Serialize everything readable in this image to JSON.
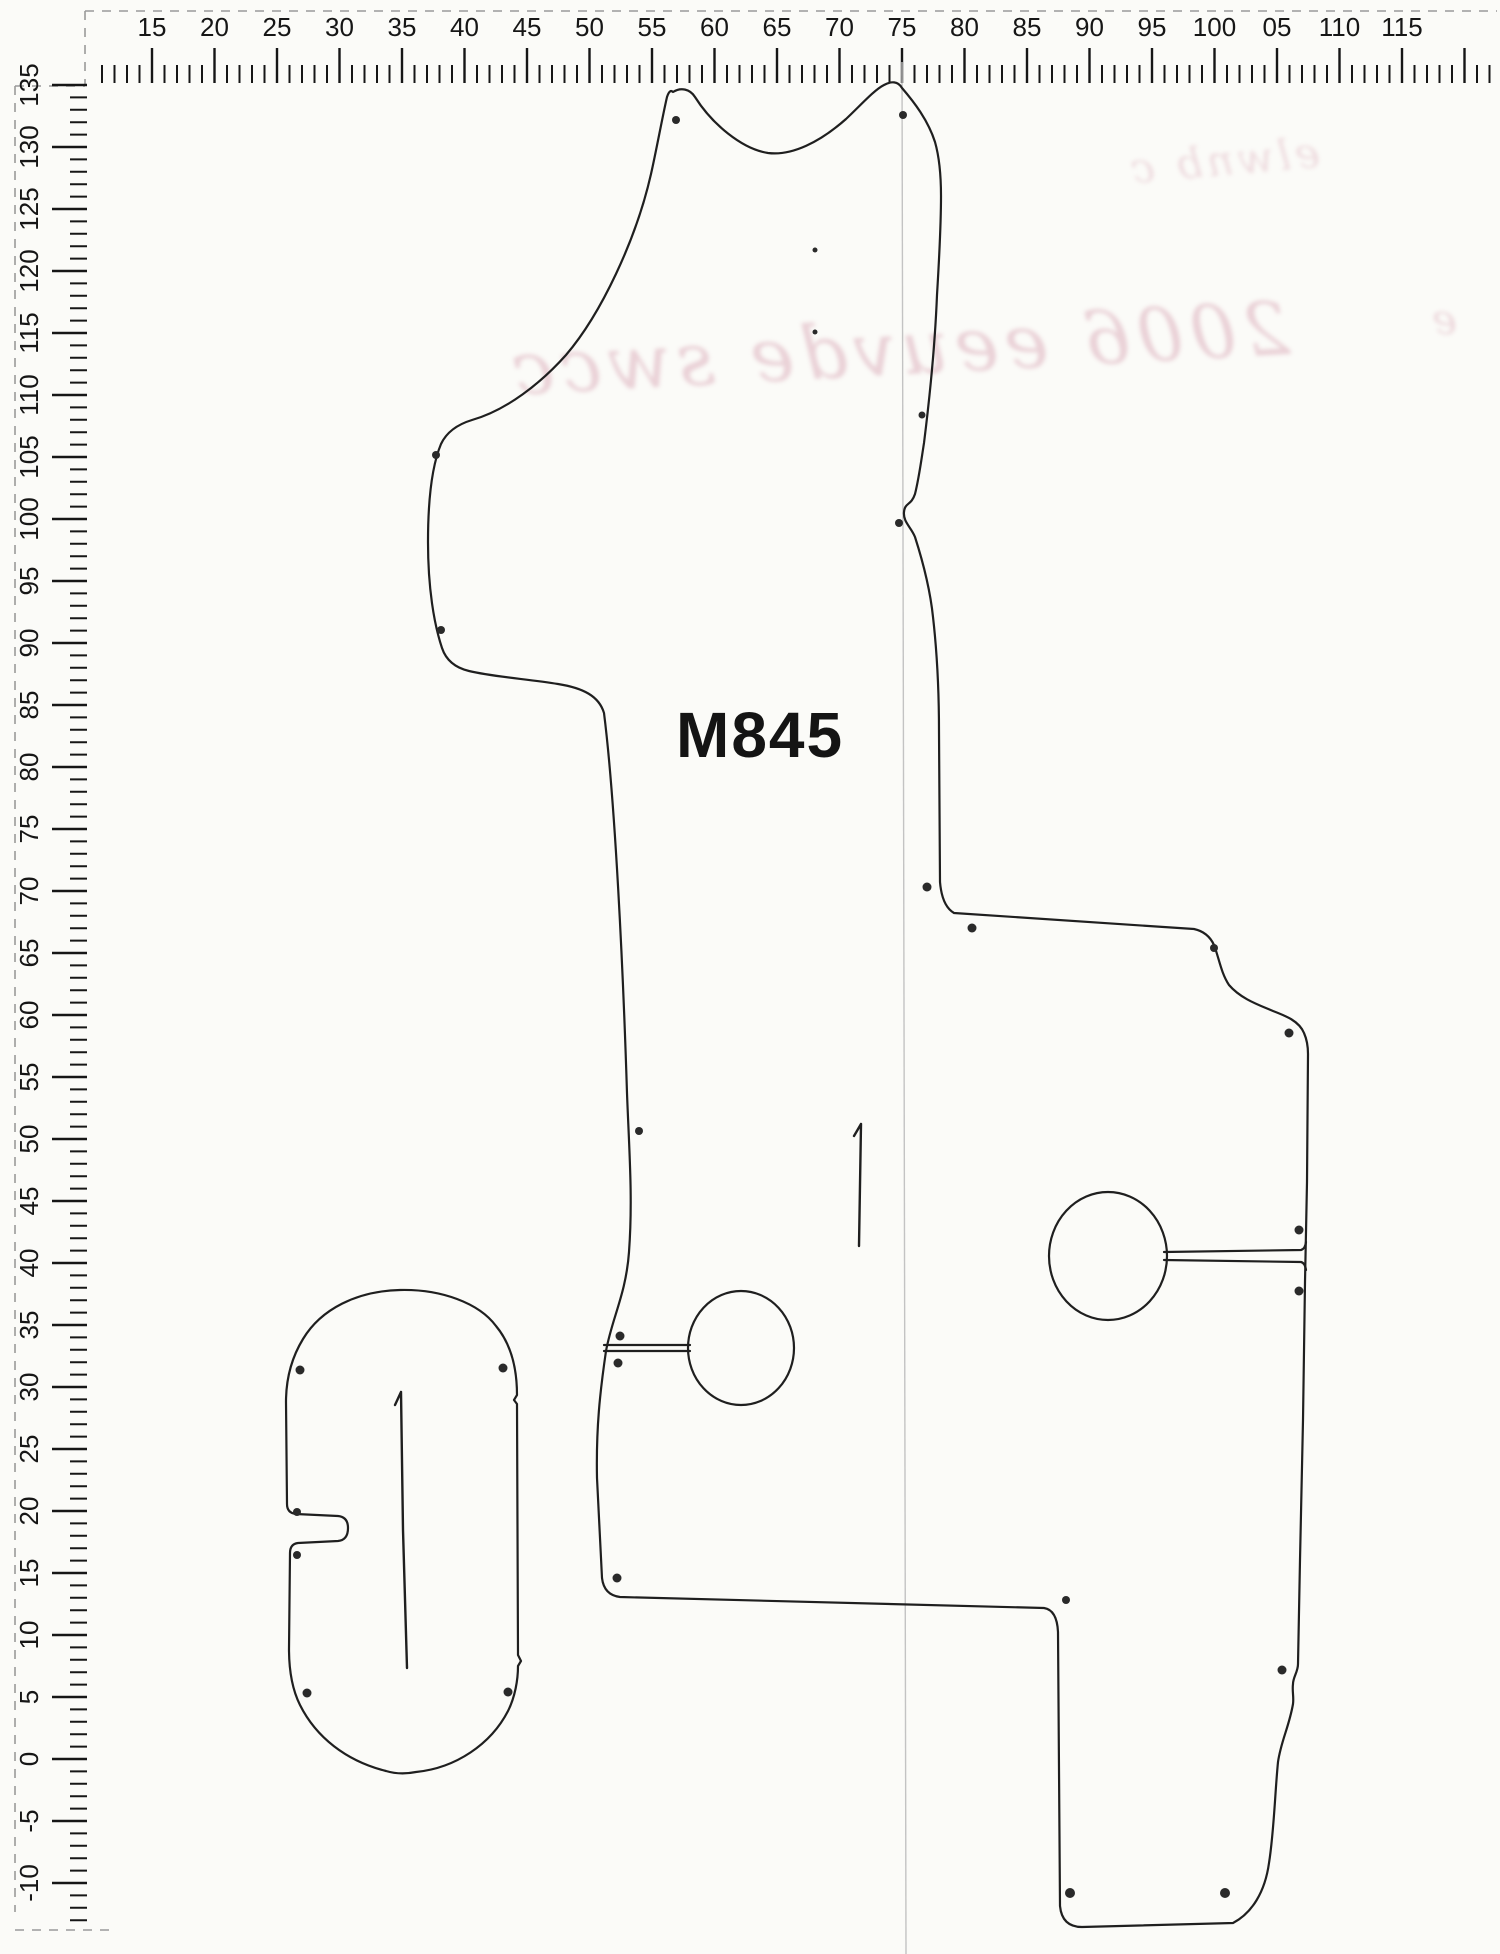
{
  "sheet": {
    "description_label": "M845",
    "units": "cm"
  },
  "part_label": {
    "text": "M845"
  },
  "top_ruler": {
    "orientation": "horizontal",
    "labels": [
      {
        "text": "15",
        "cm": 15
      },
      {
        "text": "20",
        "cm": 20
      },
      {
        "text": "25",
        "cm": 25
      },
      {
        "text": "30",
        "cm": 30
      },
      {
        "text": "35",
        "cm": 35
      },
      {
        "text": "40",
        "cm": 40
      },
      {
        "text": "45",
        "cm": 45
      },
      {
        "text": "50",
        "cm": 50
      },
      {
        "text": "55",
        "cm": 55
      },
      {
        "text": "60",
        "cm": 60
      },
      {
        "text": "65",
        "cm": 65
      },
      {
        "text": "70",
        "cm": 70
      },
      {
        "text": "75",
        "cm": 75
      },
      {
        "text": "80",
        "cm": 80
      },
      {
        "text": "85",
        "cm": 85
      },
      {
        "text": "90",
        "cm": 90
      },
      {
        "text": "95",
        "cm": 95
      },
      {
        "text": "100",
        "cm": 100
      },
      {
        "text": "05",
        "cm": 105
      },
      {
        "text": "110",
        "cm": 110
      },
      {
        "text": "115",
        "cm": 115
      }
    ],
    "px_per_cm": 12.5,
    "origin_cm": 15,
    "origin_px": 152
  },
  "left_ruler": {
    "orientation": "vertical",
    "labels": [
      {
        "text": "135",
        "cm": 135
      },
      {
        "text": "130",
        "cm": 130
      },
      {
        "text": "125",
        "cm": 125
      },
      {
        "text": "120",
        "cm": 120
      },
      {
        "text": "115",
        "cm": 115
      },
      {
        "text": "110",
        "cm": 110
      },
      {
        "text": "105",
        "cm": 105
      },
      {
        "text": "100",
        "cm": 100
      },
      {
        "text": "95",
        "cm": 95
      },
      {
        "text": "90",
        "cm": 90
      },
      {
        "text": "85",
        "cm": 85
      },
      {
        "text": "80",
        "cm": 80
      },
      {
        "text": "75",
        "cm": 75
      },
      {
        "text": "70",
        "cm": 70
      },
      {
        "text": "65",
        "cm": 65
      },
      {
        "text": "60",
        "cm": 60
      },
      {
        "text": "55",
        "cm": 55
      },
      {
        "text": "50",
        "cm": 50
      },
      {
        "text": "45",
        "cm": 45
      },
      {
        "text": "40",
        "cm": 40
      },
      {
        "text": "35",
        "cm": 35
      },
      {
        "text": "30",
        "cm": 30
      },
      {
        "text": "25",
        "cm": 25
      },
      {
        "text": "20",
        "cm": 20
      },
      {
        "text": "15",
        "cm": 15
      },
      {
        "text": "10",
        "cm": 10
      },
      {
        "text": "5",
        "cm": 5
      },
      {
        "text": "0",
        "cm": 0
      },
      {
        "text": "-5",
        "cm": -5
      },
      {
        "text": "-10",
        "cm": -10
      }
    ],
    "px_per_cm": 12.4,
    "origin_cm": 135,
    "origin_px": 85
  },
  "handwriting": {
    "legible_fragment": "2006",
    "squiggle_tail": "eeuvde swcc",
    "small_squiggle": "elwnb c",
    "stray_mark": "e",
    "style_note": "mirrored pen bleed-through",
    "color": "#d9a8b6"
  },
  "colors": {
    "paper": "#fbfbf8",
    "ink": "#1f1f1f",
    "ruler_ink": "#161616",
    "dash": "#9a9a9a",
    "crease": "#c3c3c3",
    "dot": "#2a2a2a"
  }
}
